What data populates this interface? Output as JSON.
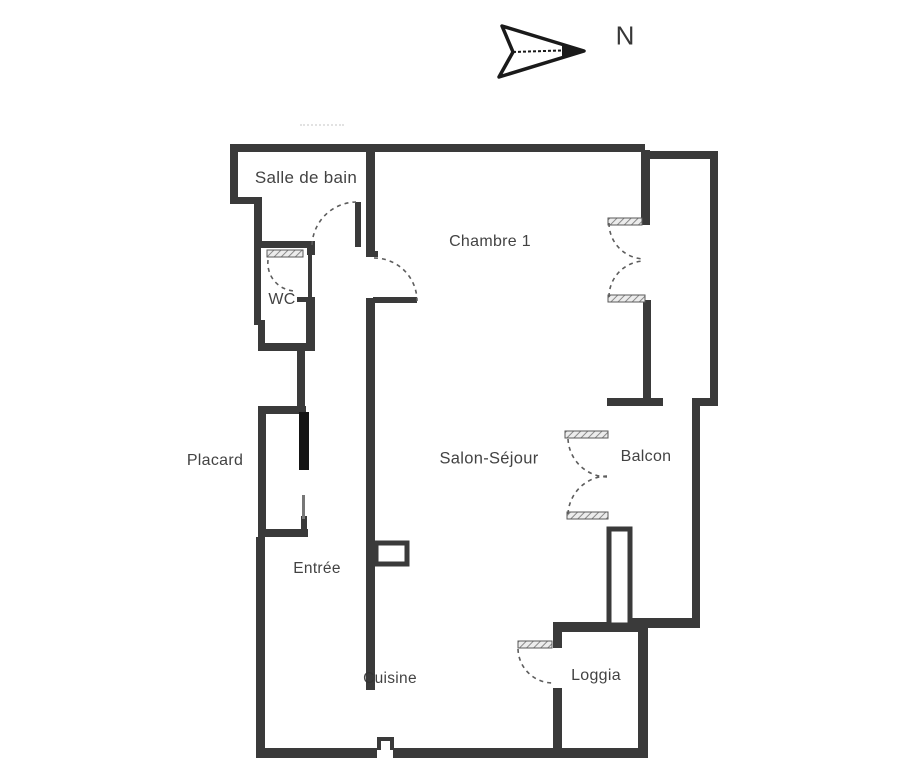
{
  "compass": {
    "label": "N"
  },
  "rooms": {
    "salle_de_bain": "Salle de bain",
    "wc": "WC",
    "chambre1": "Chambre 1",
    "placard": "Placard",
    "entree": "Entrée",
    "salon_sejour": "Salon-Séjour",
    "balcon": "Balcon",
    "cuisine": "Cuisine",
    "loggia": "Loggia"
  },
  "colors": {
    "ink": "#3a3a3a",
    "text": "#333333",
    "background": "#ffffff"
  }
}
